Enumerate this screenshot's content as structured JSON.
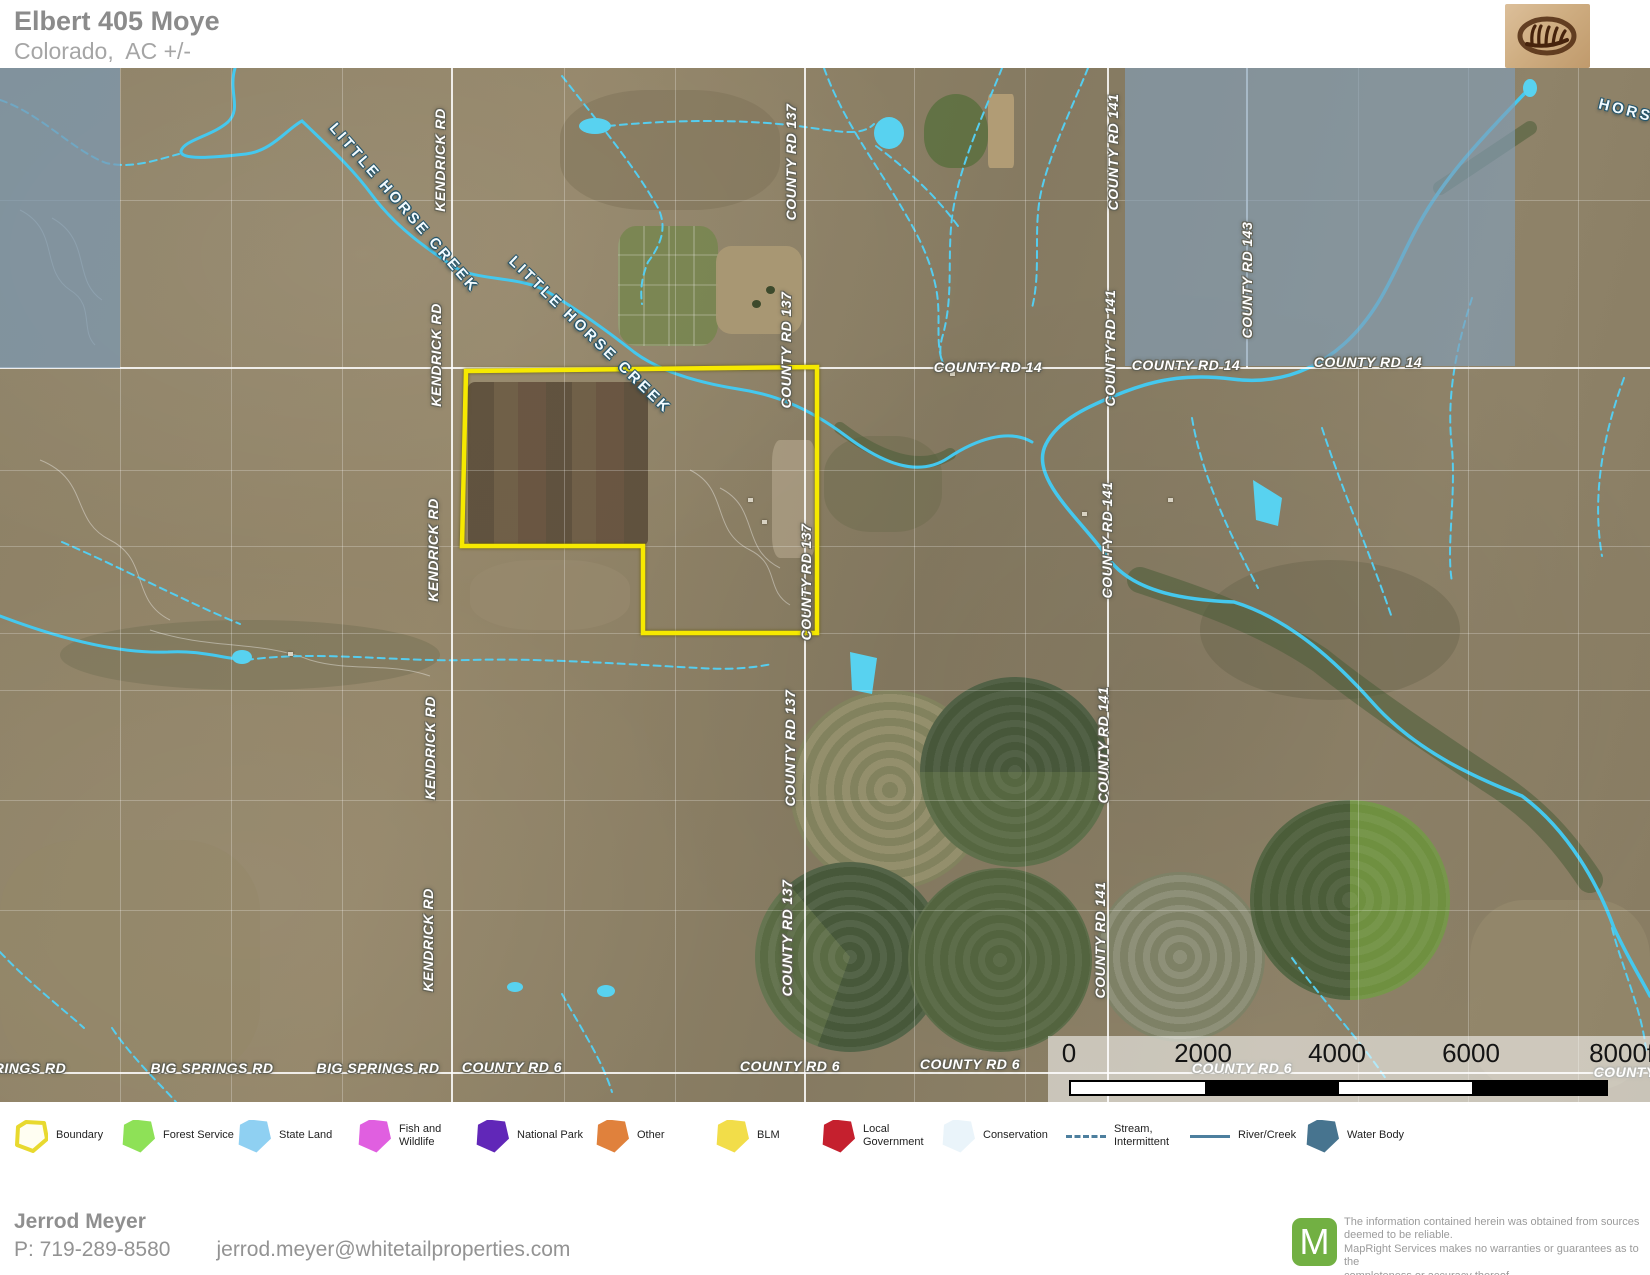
{
  "header": {
    "title": "Elbert 405 Moye",
    "subtitle": "Colorado,  AC +/-"
  },
  "brand": {
    "logo_icon": "antler-oval-logo"
  },
  "map": {
    "boundary_color": "#f6e900",
    "creek_labels": [
      {
        "text": "LITTLE HORSE CREEK",
        "x": 404,
        "y": 140,
        "rot": 49
      },
      {
        "text": "LITTLE HORSE CREEK",
        "x": 590,
        "y": 267,
        "rot": 44
      },
      {
        "text": "HORSE",
        "x": 1632,
        "y": 44,
        "rot": 14
      }
    ],
    "road_labels": [
      {
        "text": "KENDRICK RD",
        "x": 440,
        "y": 92,
        "rot": -90
      },
      {
        "text": "KENDRICK RD",
        "x": 436,
        "y": 287,
        "rot": -90
      },
      {
        "text": "KENDRICK RD",
        "x": 433,
        "y": 482,
        "rot": -90
      },
      {
        "text": "KENDRICK RD",
        "x": 430,
        "y": 680,
        "rot": -90
      },
      {
        "text": "KENDRICK RD",
        "x": 428,
        "y": 872,
        "rot": -90
      },
      {
        "text": "COUNTY RD 137",
        "x": 791,
        "y": 94,
        "rot": -90
      },
      {
        "text": "COUNTY RD 137",
        "x": 786,
        "y": 282,
        "rot": -90
      },
      {
        "text": "COUNTY RD 137",
        "x": 806,
        "y": 514,
        "rot": -90
      },
      {
        "text": "COUNTY RD 137",
        "x": 790,
        "y": 680,
        "rot": -90
      },
      {
        "text": "COUNTY RD 137",
        "x": 787,
        "y": 870,
        "rot": -90
      },
      {
        "text": "COUNTY RD 141",
        "x": 1113,
        "y": 84,
        "rot": -90
      },
      {
        "text": "COUNTY RD 141",
        "x": 1110,
        "y": 280,
        "rot": -90
      },
      {
        "text": "COUNTY RD 141",
        "x": 1107,
        "y": 472,
        "rot": -90
      },
      {
        "text": "COUNTY RD 141",
        "x": 1103,
        "y": 677,
        "rot": -90
      },
      {
        "text": "COUNTY RD 141",
        "x": 1100,
        "y": 872,
        "rot": -90
      },
      {
        "text": "COUNTY RD 143",
        "x": 1247,
        "y": 212,
        "rot": -90
      },
      {
        "text": "COUNTY RD 14",
        "x": 988,
        "y": 299,
        "rot": 0
      },
      {
        "text": "COUNTY RD 14",
        "x": 1186,
        "y": 297,
        "rot": 0
      },
      {
        "text": "COUNTY RD 14",
        "x": 1368,
        "y": 294,
        "rot": 0
      },
      {
        "text": "RINGS RD",
        "x": 30,
        "y": 1000,
        "rot": 0
      },
      {
        "text": "BIG SPRINGS RD",
        "x": 212,
        "y": 1000,
        "rot": 0
      },
      {
        "text": "BIG SPRINGS RD",
        "x": 378,
        "y": 1000,
        "rot": 0
      },
      {
        "text": "COUNTY RD 6",
        "x": 512,
        "y": 999,
        "rot": 0
      },
      {
        "text": "COUNTY RD 6",
        "x": 790,
        "y": 998,
        "rot": 0
      },
      {
        "text": "COUNTY RD 6",
        "x": 970,
        "y": 996,
        "rot": 0
      },
      {
        "text": "COUNTY RD 6",
        "x": 1242,
        "y": 1000,
        "rot": 0
      },
      {
        "text": "COUNTY R",
        "x": 1632,
        "y": 1004,
        "rot": 0
      }
    ],
    "scalebar": {
      "labels": [
        "0",
        "2000",
        "4000",
        "6000",
        "8000ft"
      ]
    }
  },
  "legend": {
    "items": [
      {
        "label": "Boundary",
        "type": "boundary",
        "color": "#e8d92e"
      },
      {
        "label": "Forest Service",
        "type": "area",
        "color": "#8ee157"
      },
      {
        "label": "State Land",
        "type": "area",
        "color": "#8fd0f2"
      },
      {
        "label": "Fish and Wildlife",
        "type": "area",
        "color": "#e05fe0"
      },
      {
        "label": "National Park",
        "type": "area",
        "color": "#6127b8"
      },
      {
        "label": "Other",
        "type": "area",
        "color": "#e0813c"
      },
      {
        "label": "BLM",
        "type": "area",
        "color": "#f2dd49"
      },
      {
        "label": "Local Government",
        "type": "area",
        "color": "#c5202e"
      },
      {
        "label": "Conservation",
        "type": "area",
        "color": "#eaf4fa"
      },
      {
        "label": "Stream, Intermittent",
        "type": "dashed-line",
        "color": "#4d7f9e"
      },
      {
        "label": "River/Creek",
        "type": "line",
        "color": "#4d7f9e"
      },
      {
        "label": "Water Body",
        "type": "area",
        "color": "#47748f"
      }
    ]
  },
  "footer": {
    "agent": "Jerrod Meyer",
    "phone": "P: 719-289-8580",
    "email": "jerrod.meyer@whitetailproperties.com",
    "maplogo_letter": "M",
    "disclaimer": "The information contained herein was obtained from sources\ndeemed to be reliable.\n MapRight Services makes no warranties or guarantees as to the\ncompleteness or accuracy thereof."
  }
}
